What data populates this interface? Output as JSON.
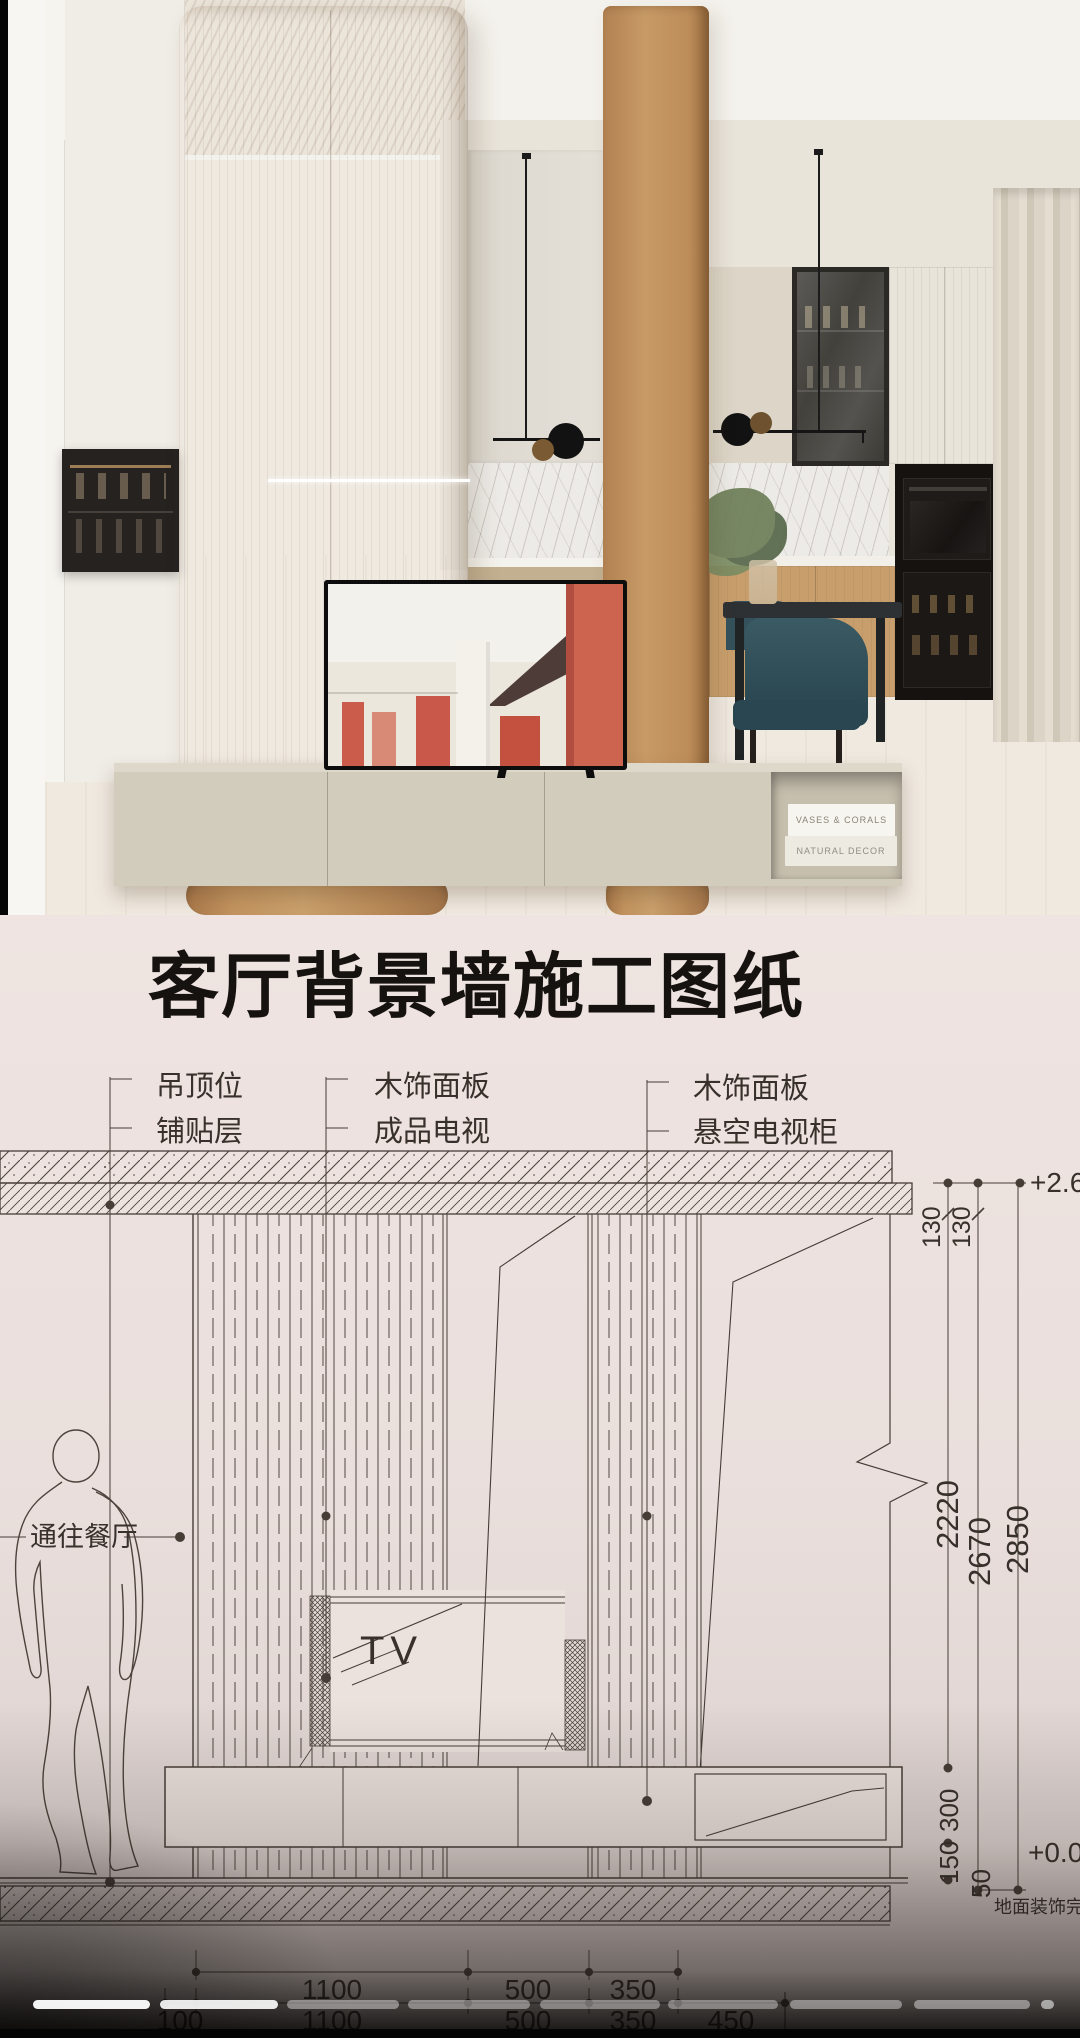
{
  "photo": {
    "books_line1": "VASES & CORALS",
    "books_line2": "NATURAL DECOR"
  },
  "blueprint": {
    "title": "客厅背景墙施工图纸",
    "labels": {
      "g1a": "吊顶位",
      "g1b": "铺贴层",
      "g2a": "木饰面板",
      "g2b": "成品电视",
      "g3a": "木饰面板",
      "g3b": "悬空电视柜",
      "passage": "通往餐厅",
      "tv": "TV",
      "floor_note": "地面装饰完"
    },
    "levels": {
      "ceiling": "+2.6",
      "floor": "+0.0"
    },
    "dims": {
      "right": [
        "130",
        "130",
        "2220",
        "2670",
        "2850",
        "300",
        "150",
        "50"
      ],
      "bottom_row1": [
        "1100",
        "500",
        "350"
      ],
      "bottom_row2": [
        "100",
        "1100",
        "500",
        "350",
        "450"
      ]
    },
    "colors": {
      "paper": "#ece2de",
      "ink": "#3d342e"
    }
  }
}
